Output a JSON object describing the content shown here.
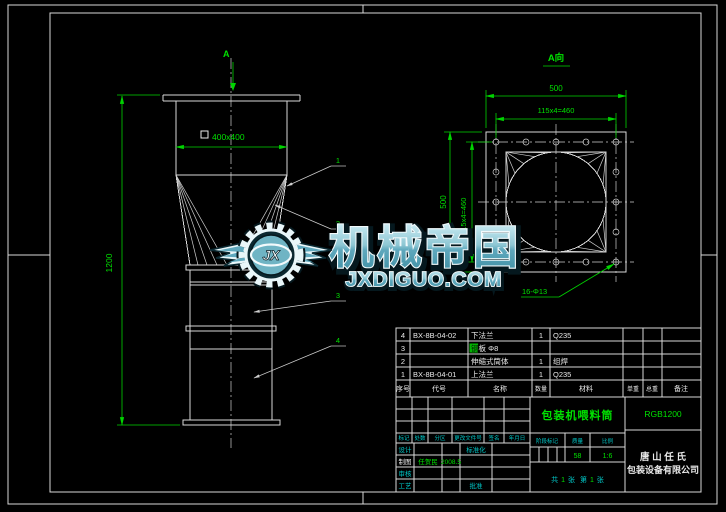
{
  "front_view": {
    "view_marker": "A",
    "dim_square": "400x400",
    "dim_height": "1200",
    "balloons": [
      "1",
      "2",
      "3",
      "4"
    ]
  },
  "view_a": {
    "label": "A向",
    "dim_top_outer": "500",
    "dim_top_holes": "115x4=460",
    "dim_left_outer": "500",
    "dim_left_holes": "115x4=460",
    "hole_note": "16-Φ13"
  },
  "parts_table": {
    "headers": [
      "序号",
      "代号",
      "名称",
      "数量",
      "材料",
      "单重",
      "总重",
      "备注"
    ],
    "rows": [
      {
        "no": "4",
        "code": "BX-8B-04-02",
        "name": "下法兰",
        "qty": "1",
        "material": "Q235"
      },
      {
        "no": "3",
        "code": "",
        "name_hl": "钢",
        "name_rest": "板 Φ8",
        "qty": "",
        "material": ""
      },
      {
        "no": "2",
        "code": "",
        "name": "伸缩式筒体",
        "qty": "1",
        "material": "组焊"
      },
      {
        "no": "1",
        "code": "BX-8B-04-01",
        "name": "上法兰",
        "qty": "1",
        "material": "Q235"
      }
    ]
  },
  "title_block": {
    "title": "包装机喂料筒",
    "drawing_no": "RGB1200",
    "company_line1": "唐 山 任 氏",
    "company_line2": "包装设备有限公司",
    "rev_headers": [
      "标记",
      "处数",
      "分区",
      "更改文件号",
      "签名",
      "年月日"
    ],
    "labels": {
      "design": "设计",
      "draft": "制图",
      "check": "审核",
      "process": "工艺",
      "standard": "标准化",
      "approve": "批准",
      "stage": "阶段标记",
      "weight": "质量",
      "scale": "比例"
    },
    "signature": "任贺民",
    "sign_date": "2008.5",
    "values": {
      "weight": "58",
      "scale": "1:6"
    },
    "sheet": {
      "t1": "共",
      "n1": "1",
      "t2": "张",
      "t3": "第",
      "n2": "1",
      "t4": "张"
    }
  },
  "watermark": {
    "brand": "机械帝国",
    "domain": "JXDIGUO.COM",
    "monogram": "JX",
    "teal": "#5fa8bd"
  },
  "colors": {
    "background": "#000000",
    "cad_white": "#d9d9d9",
    "cad_green": "#00e100",
    "cad_cyan": "#00c8c8"
  }
}
